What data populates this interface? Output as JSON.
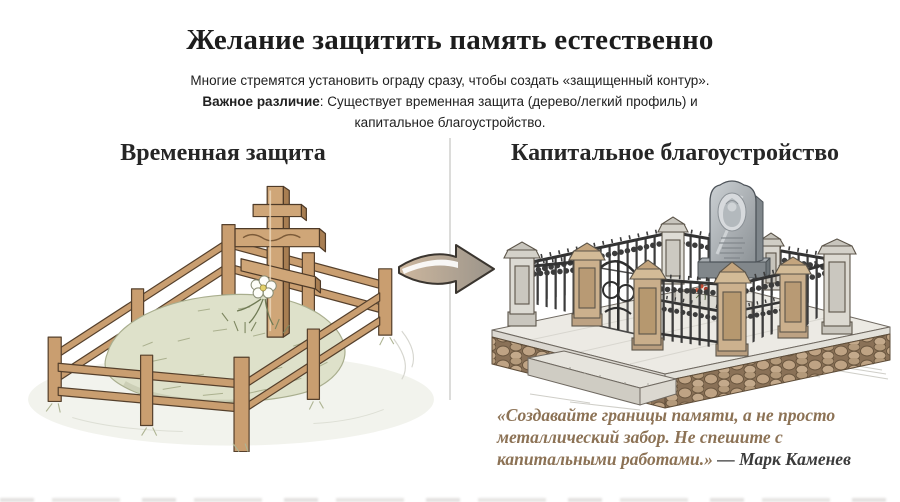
{
  "header": {
    "title": "Желание защитить память естественно",
    "subtitle_line1": "Многие стремятся установить ограду сразу, чтобы создать «защищенный контур».",
    "subtitle_emphasis": "Важное различие",
    "subtitle_line2": ": Существует временная защита (дерево/легкий профиль) и",
    "subtitle_line3": "капитальное благоустройство."
  },
  "panels": {
    "left": {
      "heading": "Временная защита",
      "illustration_alt": "wooden two-rail fence around grass grave mound with orthodox wooden cross and white flower"
    },
    "right": {
      "heading": "Капитальное благоустройство",
      "illustration_alt": "stone platform with masonry base, stone pillars, wrought-iron fence, gate and granite headstone"
    }
  },
  "quote": {
    "text": "«Создавайте границы памяти, а не просто металлический забор. Не спешите с капитальными работами.»",
    "attribution": "— Марк Каменев"
  },
  "icons": {
    "arrow": "transition-arrow-right"
  },
  "colors": {
    "quote_text": "#8c7255",
    "quote_attribution": "#3b3b3b",
    "divider": "#dcdcda",
    "wood": "#c99e70",
    "mound_green": "#dee1ca",
    "stone_tan": "#cbb08d",
    "iron": "#3c3c3c",
    "granite": "#a9aeb2",
    "arrow_tan": "#cdb79e",
    "arrow_gray": "#9b948a"
  }
}
